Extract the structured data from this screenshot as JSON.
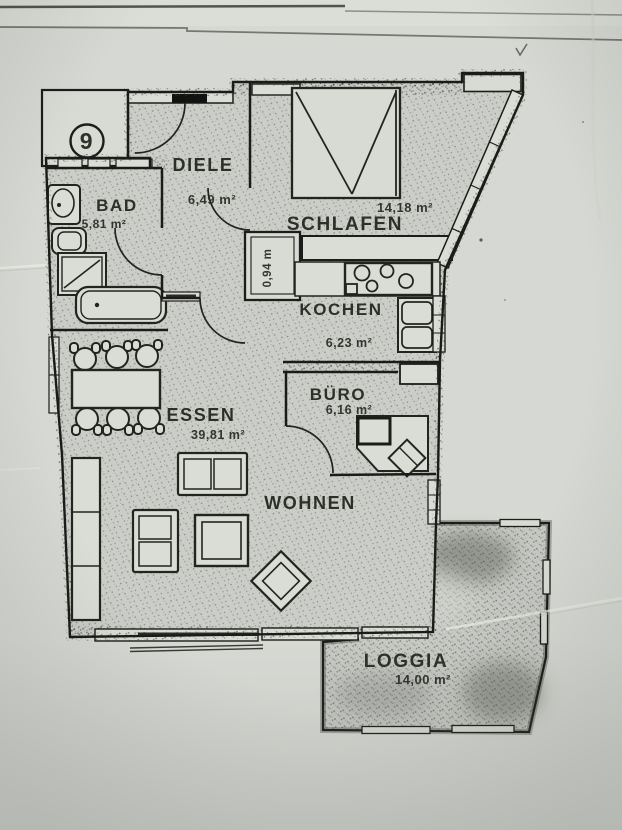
{
  "document": {
    "type": "apartment floor plan (scanned)",
    "unit_number": "9"
  },
  "rooms": [
    {
      "key": "diele",
      "name": "DIELE",
      "area": "6,49 m²"
    },
    {
      "key": "bad",
      "name": "BAD",
      "area": "5,81 m²"
    },
    {
      "key": "schlafen",
      "name": "SCHLAFEN",
      "area": "14,18 m²"
    },
    {
      "key": "kochen",
      "name": "KOCHEN",
      "area": "6,23 m²"
    },
    {
      "key": "buero",
      "name": "BÜRO",
      "area": "6,16 m²"
    },
    {
      "key": "essen",
      "name": "ESSEN",
      "area": "39,81 m²"
    },
    {
      "key": "wohnen",
      "name": "WOHNEN",
      "area": ""
    },
    {
      "key": "loggia",
      "name": "LOGGIA",
      "area": "14,00 m²"
    },
    {
      "key": "schacht",
      "name": "",
      "area": "0,94 m"
    }
  ],
  "colors": {
    "paper": "#d6d9d3",
    "ink": "#1c1c1a",
    "room_fill": "#cbcec8",
    "stipple": "#45463f",
    "loggia_shade": "#54564f"
  }
}
